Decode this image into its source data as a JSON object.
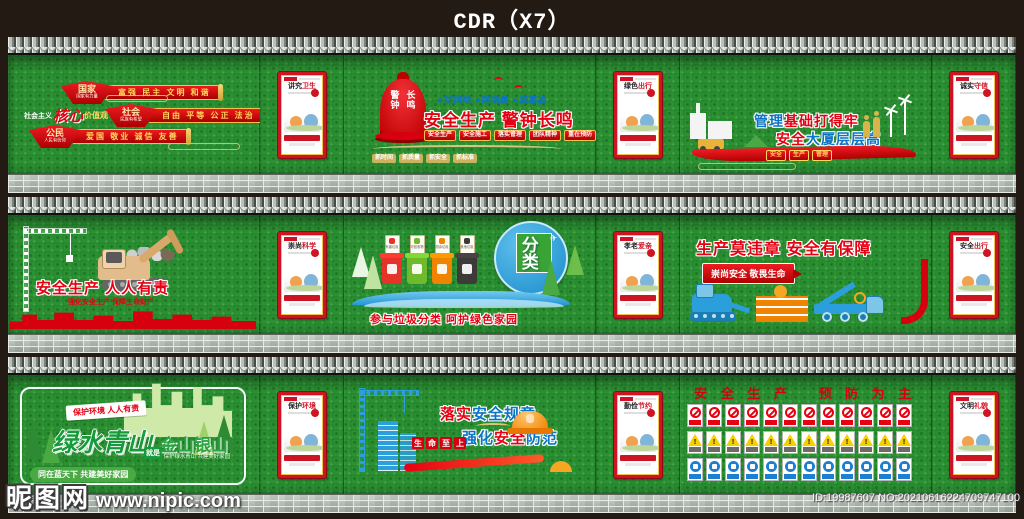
{
  "header": {
    "title": "CDR（X7）"
  },
  "watermark": {
    "site": "昵图网",
    "url": "www.nipic.com",
    "id_no": "ID:19987607 NO:20210616224709747100"
  },
  "colors": {
    "accent_red": "#e60012",
    "gold": "#f2c14e",
    "accent_blue": "#0b74c5",
    "wall_green": "#2c9133",
    "warning_yellow": "#f5cf00",
    "sign_blue": "#1e7fd0"
  },
  "core_values": {
    "side_prefix": "社会主义",
    "side_accent": "核心",
    "side_suffix": "价值观",
    "rows": [
      {
        "fan": "国家",
        "fan_sub": "国家有力量",
        "banner": "富强 民主 文明 和谐"
      },
      {
        "fan": "社会",
        "fan_sub": "民族有希望",
        "banner": "自由 平等 公正 法治"
      },
      {
        "fan": "公民",
        "fan_sub": "人民有信仰",
        "banner": "爱国 敬业 诚信 友善"
      }
    ]
  },
  "bell_mural": {
    "bell_line1": "警钟",
    "bell_line2": "长鸣",
    "subtitle": "★防风险 ★除隐患 ★遏事故",
    "title": "安全生产 警钟长鸣",
    "red_tabs": [
      "安全生产",
      "安全施工",
      "落实管理",
      "团队精神",
      "重在预防"
    ],
    "gold_tabs": [
      "抓时间",
      "抓质量",
      "抓安全",
      "抓标准"
    ]
  },
  "manage_mural": {
    "line1_a": "管理",
    "line1_b": "基础打得牢",
    "line2_a": "安全",
    "line2_b": "大厦层层高",
    "tabs": [
      "安全",
      "生产",
      "管理"
    ]
  },
  "responsibility_mural": {
    "title": "安全生产  人人有责",
    "subtitle": "强化安全生产 保障生命财产"
  },
  "garbage_mural": {
    "circle_main": "垃圾",
    "circle_tag": "分类",
    "plane_icon": "✈",
    "bins": [
      {
        "label": "有害垃圾",
        "color": "#e6332a"
      },
      {
        "label": "可回收物",
        "color": "#6fb92c"
      },
      {
        "label": "厨余垃圾",
        "color": "#f08300"
      },
      {
        "label": "其他垃圾",
        "color": "#3e3a39"
      }
    ],
    "slogan": "参与垃圾分类  呵护绿色家园"
  },
  "violation_mural": {
    "title": "生产莫违章  安全有保障",
    "banner": "崇尚安全 敬畏生命"
  },
  "green_mural": {
    "ribbon": "保护环境 人人有责",
    "main1": "绿水青山",
    "link": "就是",
    "main2": "金山银山",
    "sub": "保护绿水青山 共建美好家园",
    "bottom": "同在蓝天下 共建美好家园"
  },
  "rules_mural": {
    "line1": [
      {
        "t": "落实",
        "c": "tc-red"
      },
      {
        "t": "安全规章",
        "c": "tc-blue"
      }
    ],
    "line2": [
      {
        "t": "强化",
        "c": "tc-blue"
      },
      {
        "t": "安全",
        "c": "tc-red"
      },
      {
        "t": "防范",
        "c": "tc-blue"
      }
    ],
    "squares": [
      "生",
      "命",
      "至",
      "上"
    ]
  },
  "signs_mural": {
    "title": "安 全 生 产　 预 防 为 主",
    "prohibition_count": 12,
    "warning_count": 12,
    "mandatory_count": 12
  },
  "posters": [
    {
      "black": "讲究",
      "red": "卫生"
    },
    {
      "black": "绿色",
      "red": "出行"
    },
    {
      "black": "诚实",
      "red": "守信"
    },
    {
      "black": "崇尚",
      "red": "科学"
    },
    {
      "black": "孝老",
      "red": "爱亲"
    },
    {
      "black": "安全",
      "red": "出行"
    },
    {
      "black": "保护",
      "red": "环境"
    },
    {
      "black": "勤俭",
      "red": "节约"
    },
    {
      "black": "文明",
      "red": "礼貌"
    }
  ]
}
